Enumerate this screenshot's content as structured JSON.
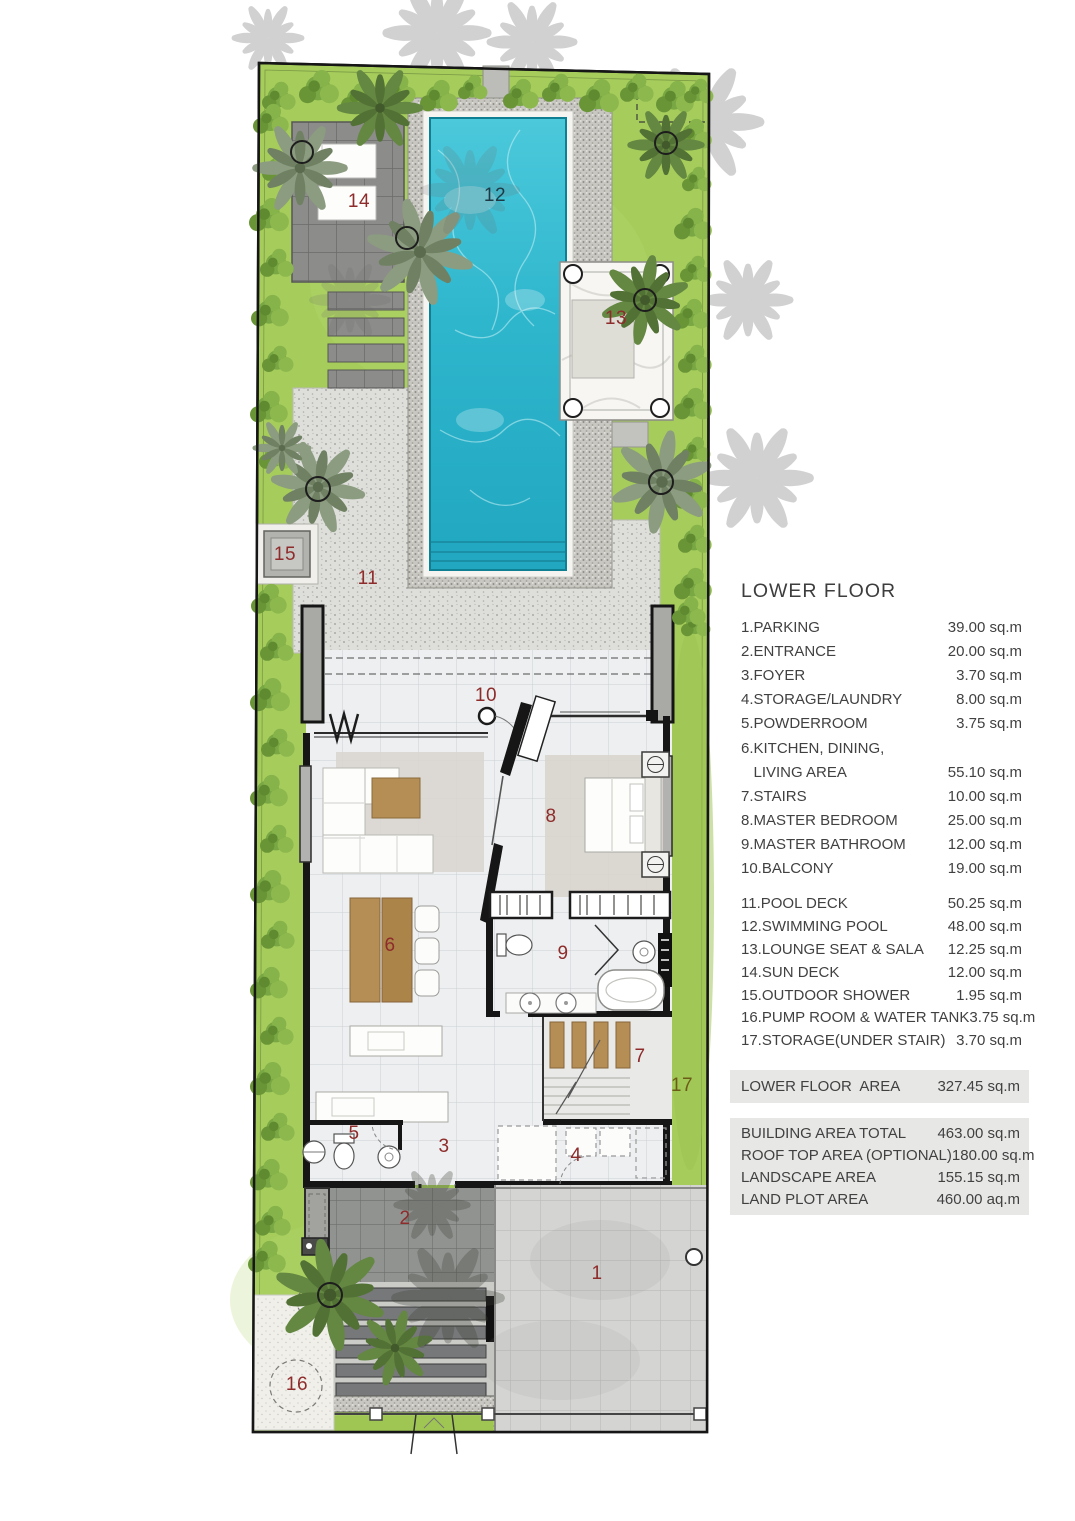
{
  "plan": {
    "colors": {
      "red": "#8e2b2b",
      "dark": "#1d3a46",
      "olive": "#6b5d17",
      "lawn": "#a6cd5c",
      "pool_water": "#31b9cf",
      "deck": "#dedfdb",
      "wall": "#161616"
    },
    "room_labels": [
      {
        "n": "1",
        "x": 597,
        "y": 1274,
        "color": "red"
      },
      {
        "n": "2",
        "x": 405,
        "y": 1219,
        "color": "red"
      },
      {
        "n": "3",
        "x": 444,
        "y": 1147,
        "color": "red"
      },
      {
        "n": "4",
        "x": 576,
        "y": 1156,
        "color": "red"
      },
      {
        "n": "5",
        "x": 354,
        "y": 1134,
        "color": "red"
      },
      {
        "n": "6",
        "x": 390,
        "y": 946,
        "color": "red"
      },
      {
        "n": "7",
        "x": 640,
        "y": 1057,
        "color": "red"
      },
      {
        "n": "8",
        "x": 551,
        "y": 817,
        "color": "red"
      },
      {
        "n": "9",
        "x": 563,
        "y": 954,
        "color": "red"
      },
      {
        "n": "10",
        "x": 486,
        "y": 696,
        "color": "red"
      },
      {
        "n": "11",
        "x": 368,
        "y": 579,
        "color": "red"
      },
      {
        "n": "12",
        "x": 495,
        "y": 196,
        "color": "dark"
      },
      {
        "n": "13",
        "x": 616,
        "y": 319,
        "color": "red"
      },
      {
        "n": "14",
        "x": 359,
        "y": 202,
        "color": "red"
      },
      {
        "n": "15",
        "x": 285,
        "y": 555,
        "color": "red"
      },
      {
        "n": "16",
        "x": 297,
        "y": 1385,
        "color": "red"
      },
      {
        "n": "17",
        "x": 682,
        "y": 1086,
        "color": "olive"
      }
    ]
  },
  "legend": {
    "title": "LOWER FLOOR",
    "group1": [
      {
        "label": "1.PARKING",
        "value": "39.00 sq.m"
      },
      {
        "label": "2.ENTRANCE",
        "value": "20.00 sq.m"
      },
      {
        "label": "3.FOYER",
        "value": "3.70 sq.m"
      },
      {
        "label": "4.STORAGE/LAUNDRY",
        "value": "8.00 sq.m"
      },
      {
        "label": "5.POWDERROOM",
        "value": "3.75 sq.m"
      },
      {
        "label": "6.KITCHEN, DINING,",
        "value": ""
      },
      {
        "label": "   LIVING AREA",
        "value": "55.10 sq.m"
      },
      {
        "label": "7.STAIRS",
        "value": "10.00 sq.m"
      },
      {
        "label": "8.MASTER BEDROOM",
        "value": "25.00 sq.m"
      },
      {
        "label": "9.MASTER BATHROOM",
        "value": "12.00 sq.m"
      },
      {
        "label": "10.BALCONY",
        "value": "19.00 sq.m"
      }
    ],
    "group2": [
      {
        "label": "11.POOL DECK",
        "value": "50.25 sq.m"
      },
      {
        "label": "12.SWIMMING POOL",
        "value": "48.00 sq.m"
      },
      {
        "label": "13.LOUNGE SEAT & SALA",
        "value": "12.25 sq.m"
      },
      {
        "label": "14.SUN DECK",
        "value": "12.00 sq.m"
      },
      {
        "label": "15.OUTDOOR SHOWER",
        "value": "1.95 sq.m"
      },
      {
        "label": "16.PUMP ROOM & WATER TANK",
        "value": "3.75 sq.m"
      },
      {
        "label": "17.STORAGE(UNDER STAIR)",
        "value": "3.70 sq.m"
      }
    ],
    "floor_total": {
      "label": "LOWER FLOOR  AREA",
      "value": "327.45 sq.m"
    },
    "summary": [
      {
        "label": "BUILDING AREA TOTAL",
        "value": "463.00 sq.m"
      },
      {
        "label": "ROOF TOP AREA (OPTIONAL)",
        "value": "180.00 sq.m"
      },
      {
        "label": "LANDSCAPE AREA",
        "value": "155.15 sq.m"
      },
      {
        "label": "LAND PLOT AREA",
        "value": "460.00 aq.m"
      }
    ]
  }
}
